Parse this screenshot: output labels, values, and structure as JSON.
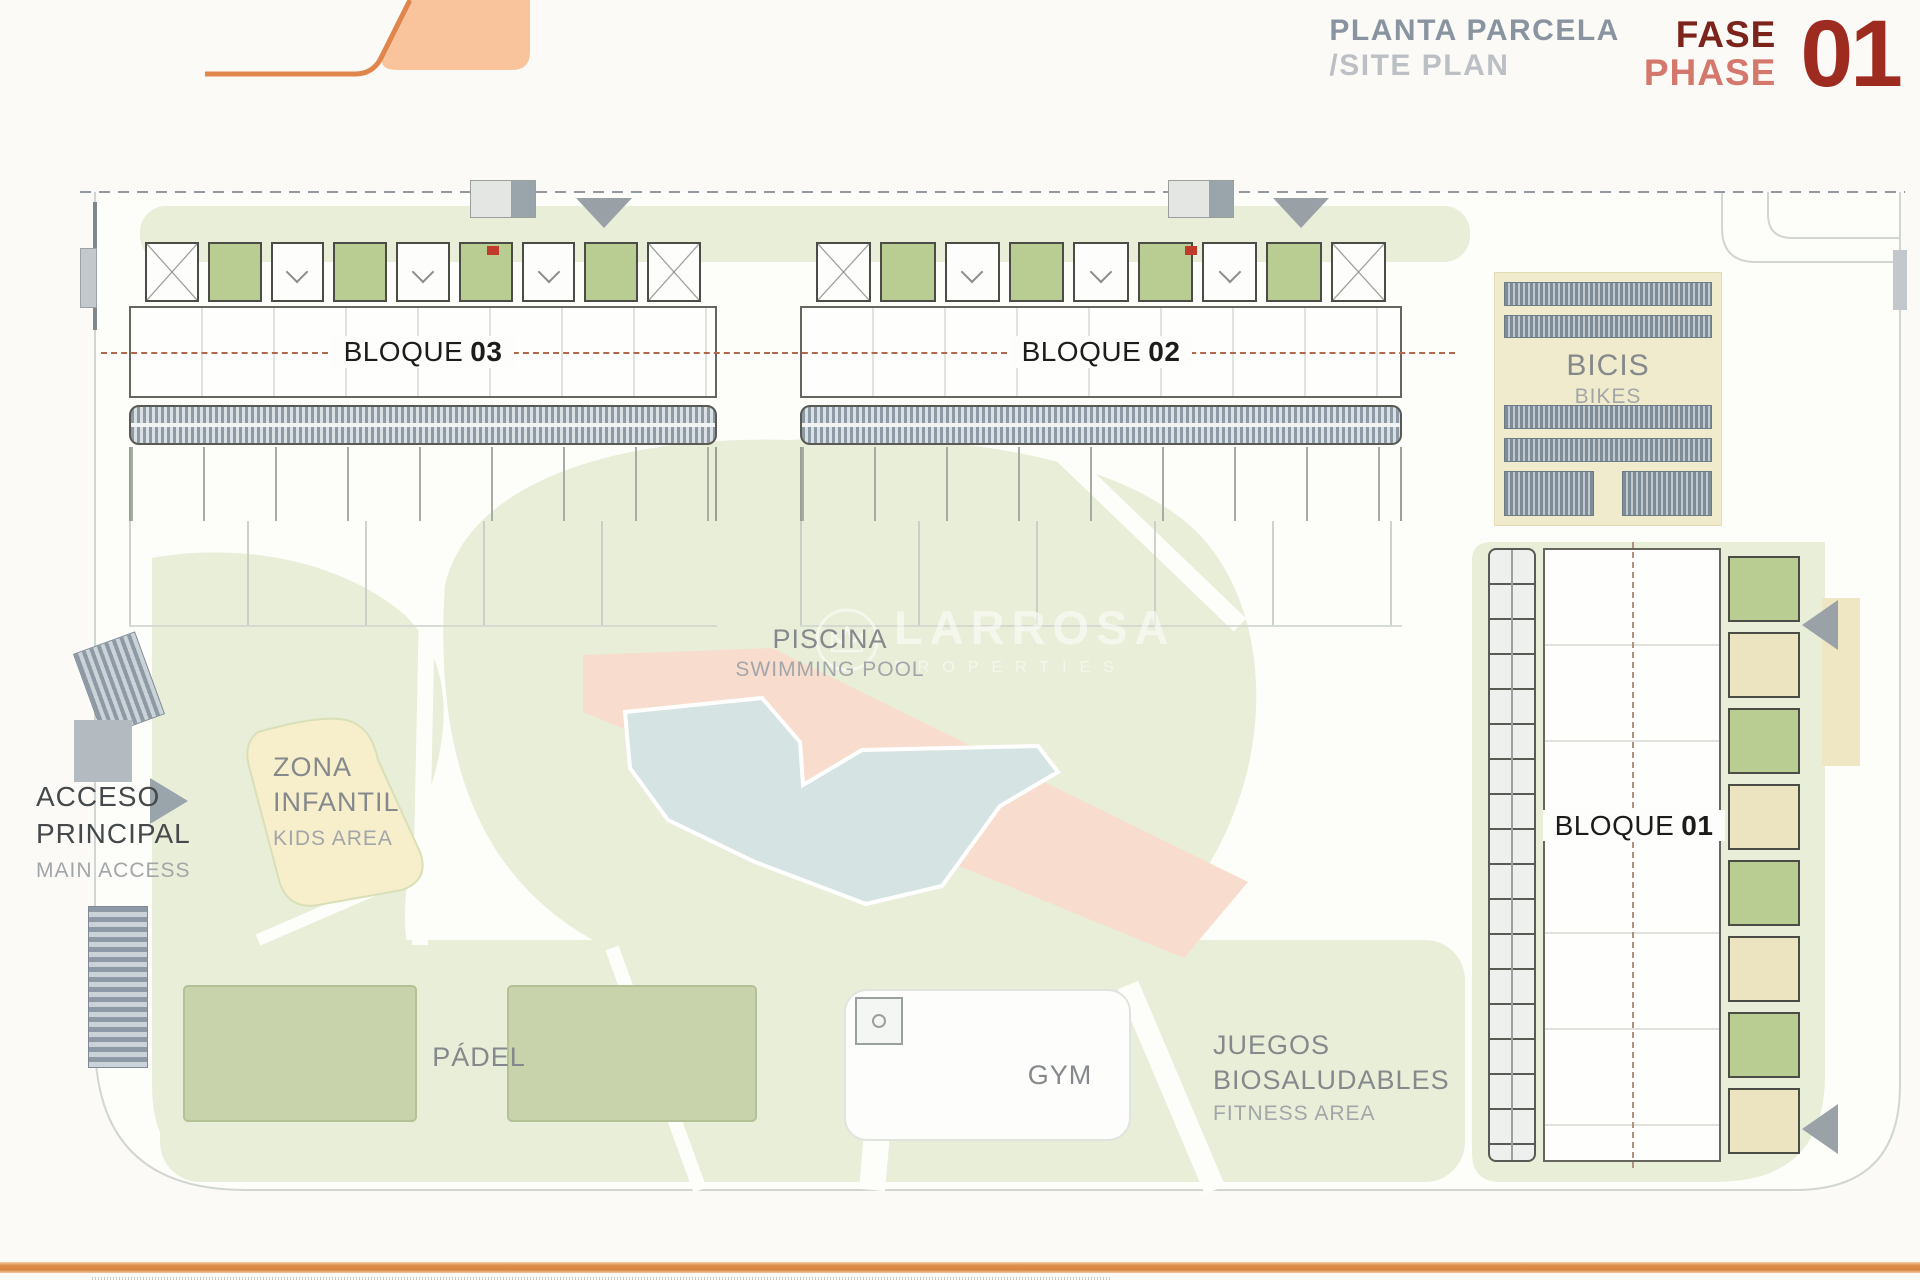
{
  "header": {
    "title_primary": "PLANTA PARCELA",
    "title_secondary": "/SITE PLAN",
    "phase_label_es": "FASE",
    "phase_label_en": "PHASE",
    "phase_number": "01"
  },
  "blocks": {
    "b01": {
      "name": "BLOQUE",
      "number": "01"
    },
    "b02": {
      "name": "BLOQUE",
      "number": "02"
    },
    "b03": {
      "name": "BLOQUE",
      "number": "03"
    }
  },
  "areas": {
    "bikes": {
      "title": "BICIS",
      "subtitle": "BIKES"
    },
    "pool": {
      "title": "PISCINA",
      "subtitle": "SWIMMING POOL"
    },
    "kids": {
      "line1": "ZONA",
      "line2": "INFANTIL",
      "subtitle": "KIDS AREA"
    },
    "access": {
      "line1": "ACCESO",
      "line2": "PRINCIPAL",
      "subtitle": "MAIN ACCESS"
    },
    "padel": {
      "title": "PÁDEL"
    },
    "gym": {
      "title": "GYM"
    },
    "fitness": {
      "line1": "JUEGOS",
      "line2": "BIOSALUDABLES",
      "subtitle": "FITNESS AREA"
    }
  },
  "watermark": {
    "brand": "LARROSA",
    "tagline": "PROPERTIES"
  },
  "colors": {
    "accent_orange": "#dd8f4e",
    "logo_fill": "#f9c49c",
    "logo_stroke": "#e0854c",
    "phase_dark_red": "#7c241c",
    "phase_salmon": "#d4776c",
    "phase_number_red": "#9e2b20",
    "header_gray": "#8a94a0",
    "header_light_gray": "#bcc0c4",
    "label_gray": "#85898c",
    "label_dark": "#45494b",
    "terrace_green": "#b9cc92",
    "balcony_cream": "#ece4c0",
    "lawn_green": "#e8eed8",
    "pool_blue": "#d5e4e2",
    "deck_salmon": "#f8ddce",
    "kids_yellow": "#f7eecb",
    "padel_green": "#c8d3ac",
    "parking_blue_gray": "#8d9aa6",
    "bikes_tan": "#f1ebcd"
  }
}
